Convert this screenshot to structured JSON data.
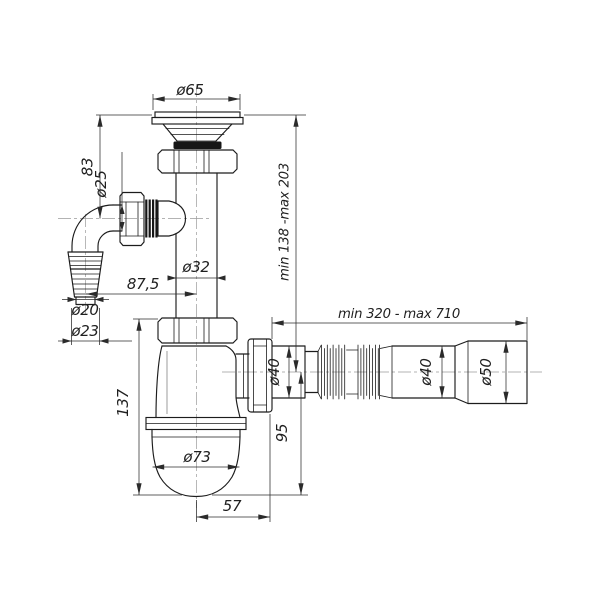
{
  "drawing": {
    "colors": {
      "background": "#ffffff",
      "line": "#1c1c1c",
      "dimension": "#2b2b2b",
      "centerline": "#9a9a9a"
    },
    "dims": {
      "flange_diameter": "ø65",
      "branch_height": "83",
      "branch_pipe_diameter": "ø25",
      "standpipe_diameter": "ø32",
      "branch_offset": "87,5",
      "hose_tip_diameter": "ø20",
      "hose_barb_diameter": "ø23",
      "inlet_height_range": "min 138 -max 203",
      "outlet_length_range": "min 320 - max 710",
      "outlet_diameter_1": "ø40",
      "outlet_diameter_2": "ø40",
      "end_cuff_diameter": "ø50",
      "trap_height": "137",
      "outlet_to_bottom": "95",
      "cup_diameter": "ø73",
      "outlet_offset": "57"
    }
  }
}
